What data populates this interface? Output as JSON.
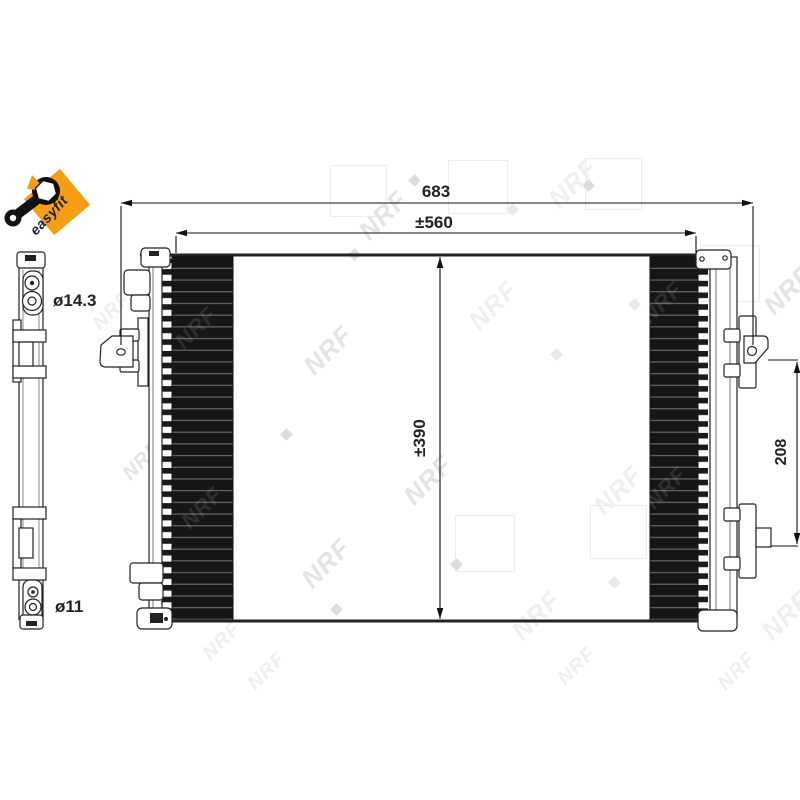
{
  "logo": {
    "text": "easyfit",
    "bg": "#F49D15"
  },
  "side_view": {
    "top_label": "ø14.3",
    "bottom_label": "ø11"
  },
  "dims": {
    "overall_width": "683",
    "core_width": "±560",
    "core_height": "±390",
    "bracket_spacing": "208"
  },
  "watermark": {
    "text": "NRF"
  },
  "colors": {
    "line": "#222222",
    "core": "#161616",
    "accent_orange": "#F49D15"
  }
}
